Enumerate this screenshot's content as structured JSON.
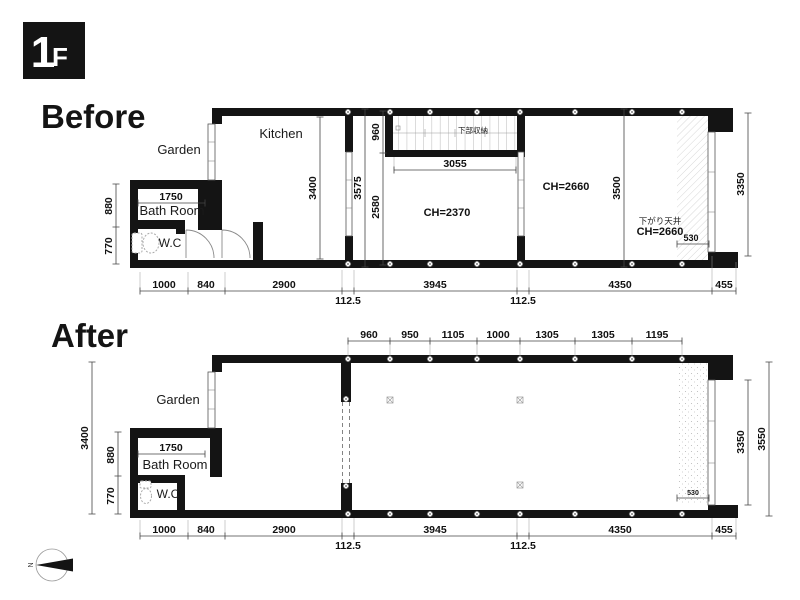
{
  "floor_badge": {
    "number": "1",
    "letter": "F"
  },
  "compass": {
    "north": "N"
  },
  "before": {
    "title": "Before",
    "rooms": {
      "garden": "Garden",
      "kitchen": "Kitchen",
      "bathroom": "Bath Room",
      "wc": "W.C"
    },
    "annotations": {
      "stair_storage": "下部収納",
      "ch_middle": "CH=2370",
      "ch_right": "CH=2660",
      "lowered_ceiling": "下がり天井",
      "lowered_ch": "CH=2660"
    },
    "dims": {
      "bath_width": "1750",
      "left_upper": "880",
      "left_lower": "770",
      "kitchen_height": "3400",
      "total_height": "3575",
      "stair_depth": "960",
      "below_stair": "2580",
      "stair_width": "3055",
      "right_height": "3500",
      "window_height": "3350",
      "lowered_width": "530",
      "bottom": [
        "1000",
        "840",
        "2900",
        "3945",
        "4350",
        "455"
      ],
      "wall_offsets": [
        "112.5",
        "112.5"
      ]
    }
  },
  "after": {
    "title": "After",
    "rooms": {
      "garden": "Garden",
      "bathroom": "Bath Room",
      "wc": "W.C"
    },
    "dims": {
      "top": [
        "960",
        "950",
        "1105",
        "1000",
        "1305",
        "1305",
        "1195"
      ],
      "bath_width": "1750",
      "left_total": "3400",
      "left_upper": "880",
      "left_lower": "770",
      "window_height": "3350",
      "right_total": "3550",
      "lowered_width": "530",
      "bottom": [
        "1000",
        "840",
        "2900",
        "3945",
        "4350",
        "455"
      ],
      "wall_offsets": [
        "112.5",
        "112.5"
      ]
    }
  }
}
